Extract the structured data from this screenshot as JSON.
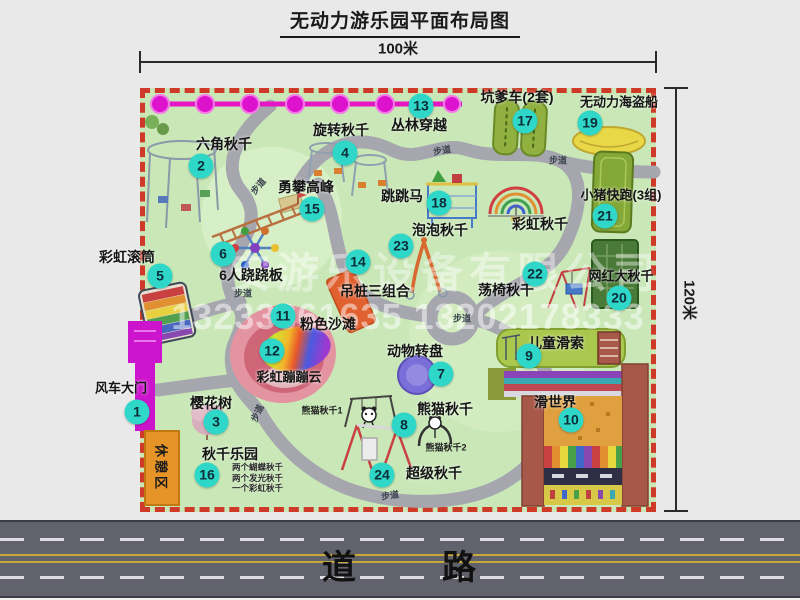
{
  "title": "无动力游乐园平面布局图",
  "dimensions": {
    "width": "100米",
    "height": "120米"
  },
  "map": {
    "attractions": [
      {
        "num": "1",
        "label": "风车大门"
      },
      {
        "num": "2",
        "label": "六角秋千"
      },
      {
        "num": "3",
        "label": "樱花树"
      },
      {
        "num": "4",
        "label": "旋转秋千"
      },
      {
        "num": "5",
        "label": "彩虹滚筒"
      },
      {
        "num": "6",
        "label": "6人跷跷板"
      },
      {
        "num": "7",
        "label": "动物转盘"
      },
      {
        "num": "8",
        "label": "熊猫秋千"
      },
      {
        "num": "9",
        "label": "儿童滑索"
      },
      {
        "num": "10",
        "label": "滑世界"
      },
      {
        "num": "11",
        "label": "粉色沙滩"
      },
      {
        "num": "12",
        "label": "彩虹蹦蹦云"
      },
      {
        "num": "13",
        "label": "丛林穿越"
      },
      {
        "num": "14",
        "label": "吊桩三组合"
      },
      {
        "num": "15",
        "label": "勇攀高峰"
      },
      {
        "num": "16",
        "label": "秋千乐园"
      },
      {
        "num": "17",
        "label": "坑爹车(2套)"
      },
      {
        "num": "18",
        "label": "跳跳马"
      },
      {
        "num": "19",
        "label": "无动力海盗船"
      },
      {
        "num": "20",
        "label": "网红大秋千"
      },
      {
        "num": "21",
        "label": "小猪快跑(3组)"
      },
      {
        "num": "22",
        "label": "荡椅秋千"
      },
      {
        "num": "23",
        "label": "泡泡秋千"
      },
      {
        "num": "24",
        "label": "超级秋千"
      }
    ],
    "unnumbered": {
      "rainbow_swing": "彩虹秋千",
      "rest_area": "休憩区",
      "panda_swing_1": "熊猫秋千1",
      "panda_swing_2": "熊猫秋千2"
    },
    "path_label": "步道",
    "swing_park_notes": [
      "两个蝴蝶秋千",
      "两个发光秋千",
      "一个彩虹秋千"
    ],
    "colors": {
      "map_bg": "#c9e7b7",
      "border_red": "#cf3a28",
      "badge": "#2fd7c9",
      "path_gray": "#a6a6ae",
      "gate_magenta": "#cc14cc",
      "jungle_line": "#e616c6"
    }
  },
  "road": {
    "label": "道路"
  },
  "watermark": {
    "company": "安游乐设备有限公司",
    "phone": "13233861635 13202178333"
  }
}
